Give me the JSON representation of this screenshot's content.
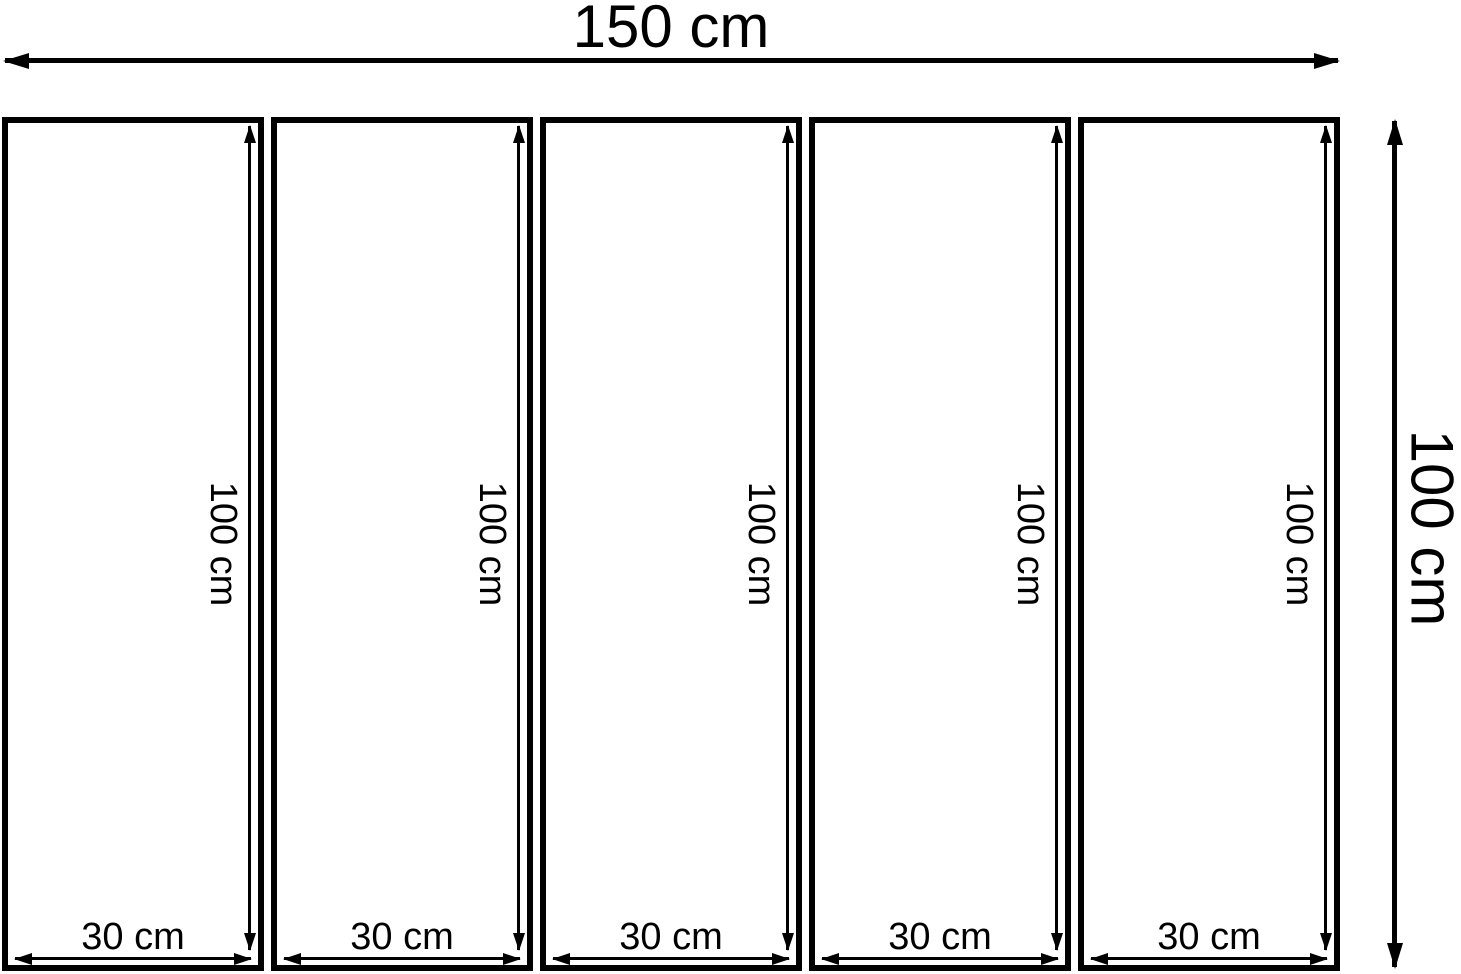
{
  "colors": {
    "line": "#000000",
    "background": "#ffffff"
  },
  "overall": {
    "width_label": "150 cm",
    "height_label": "100 cm"
  },
  "panels": [
    {
      "height_label": "100 cm",
      "width_label": "30 cm"
    },
    {
      "height_label": "100 cm",
      "width_label": "30 cm"
    },
    {
      "height_label": "100 cm",
      "width_label": "30 cm"
    },
    {
      "height_label": "100 cm",
      "width_label": "30 cm"
    },
    {
      "height_label": "100 cm",
      "width_label": "30 cm"
    }
  ]
}
